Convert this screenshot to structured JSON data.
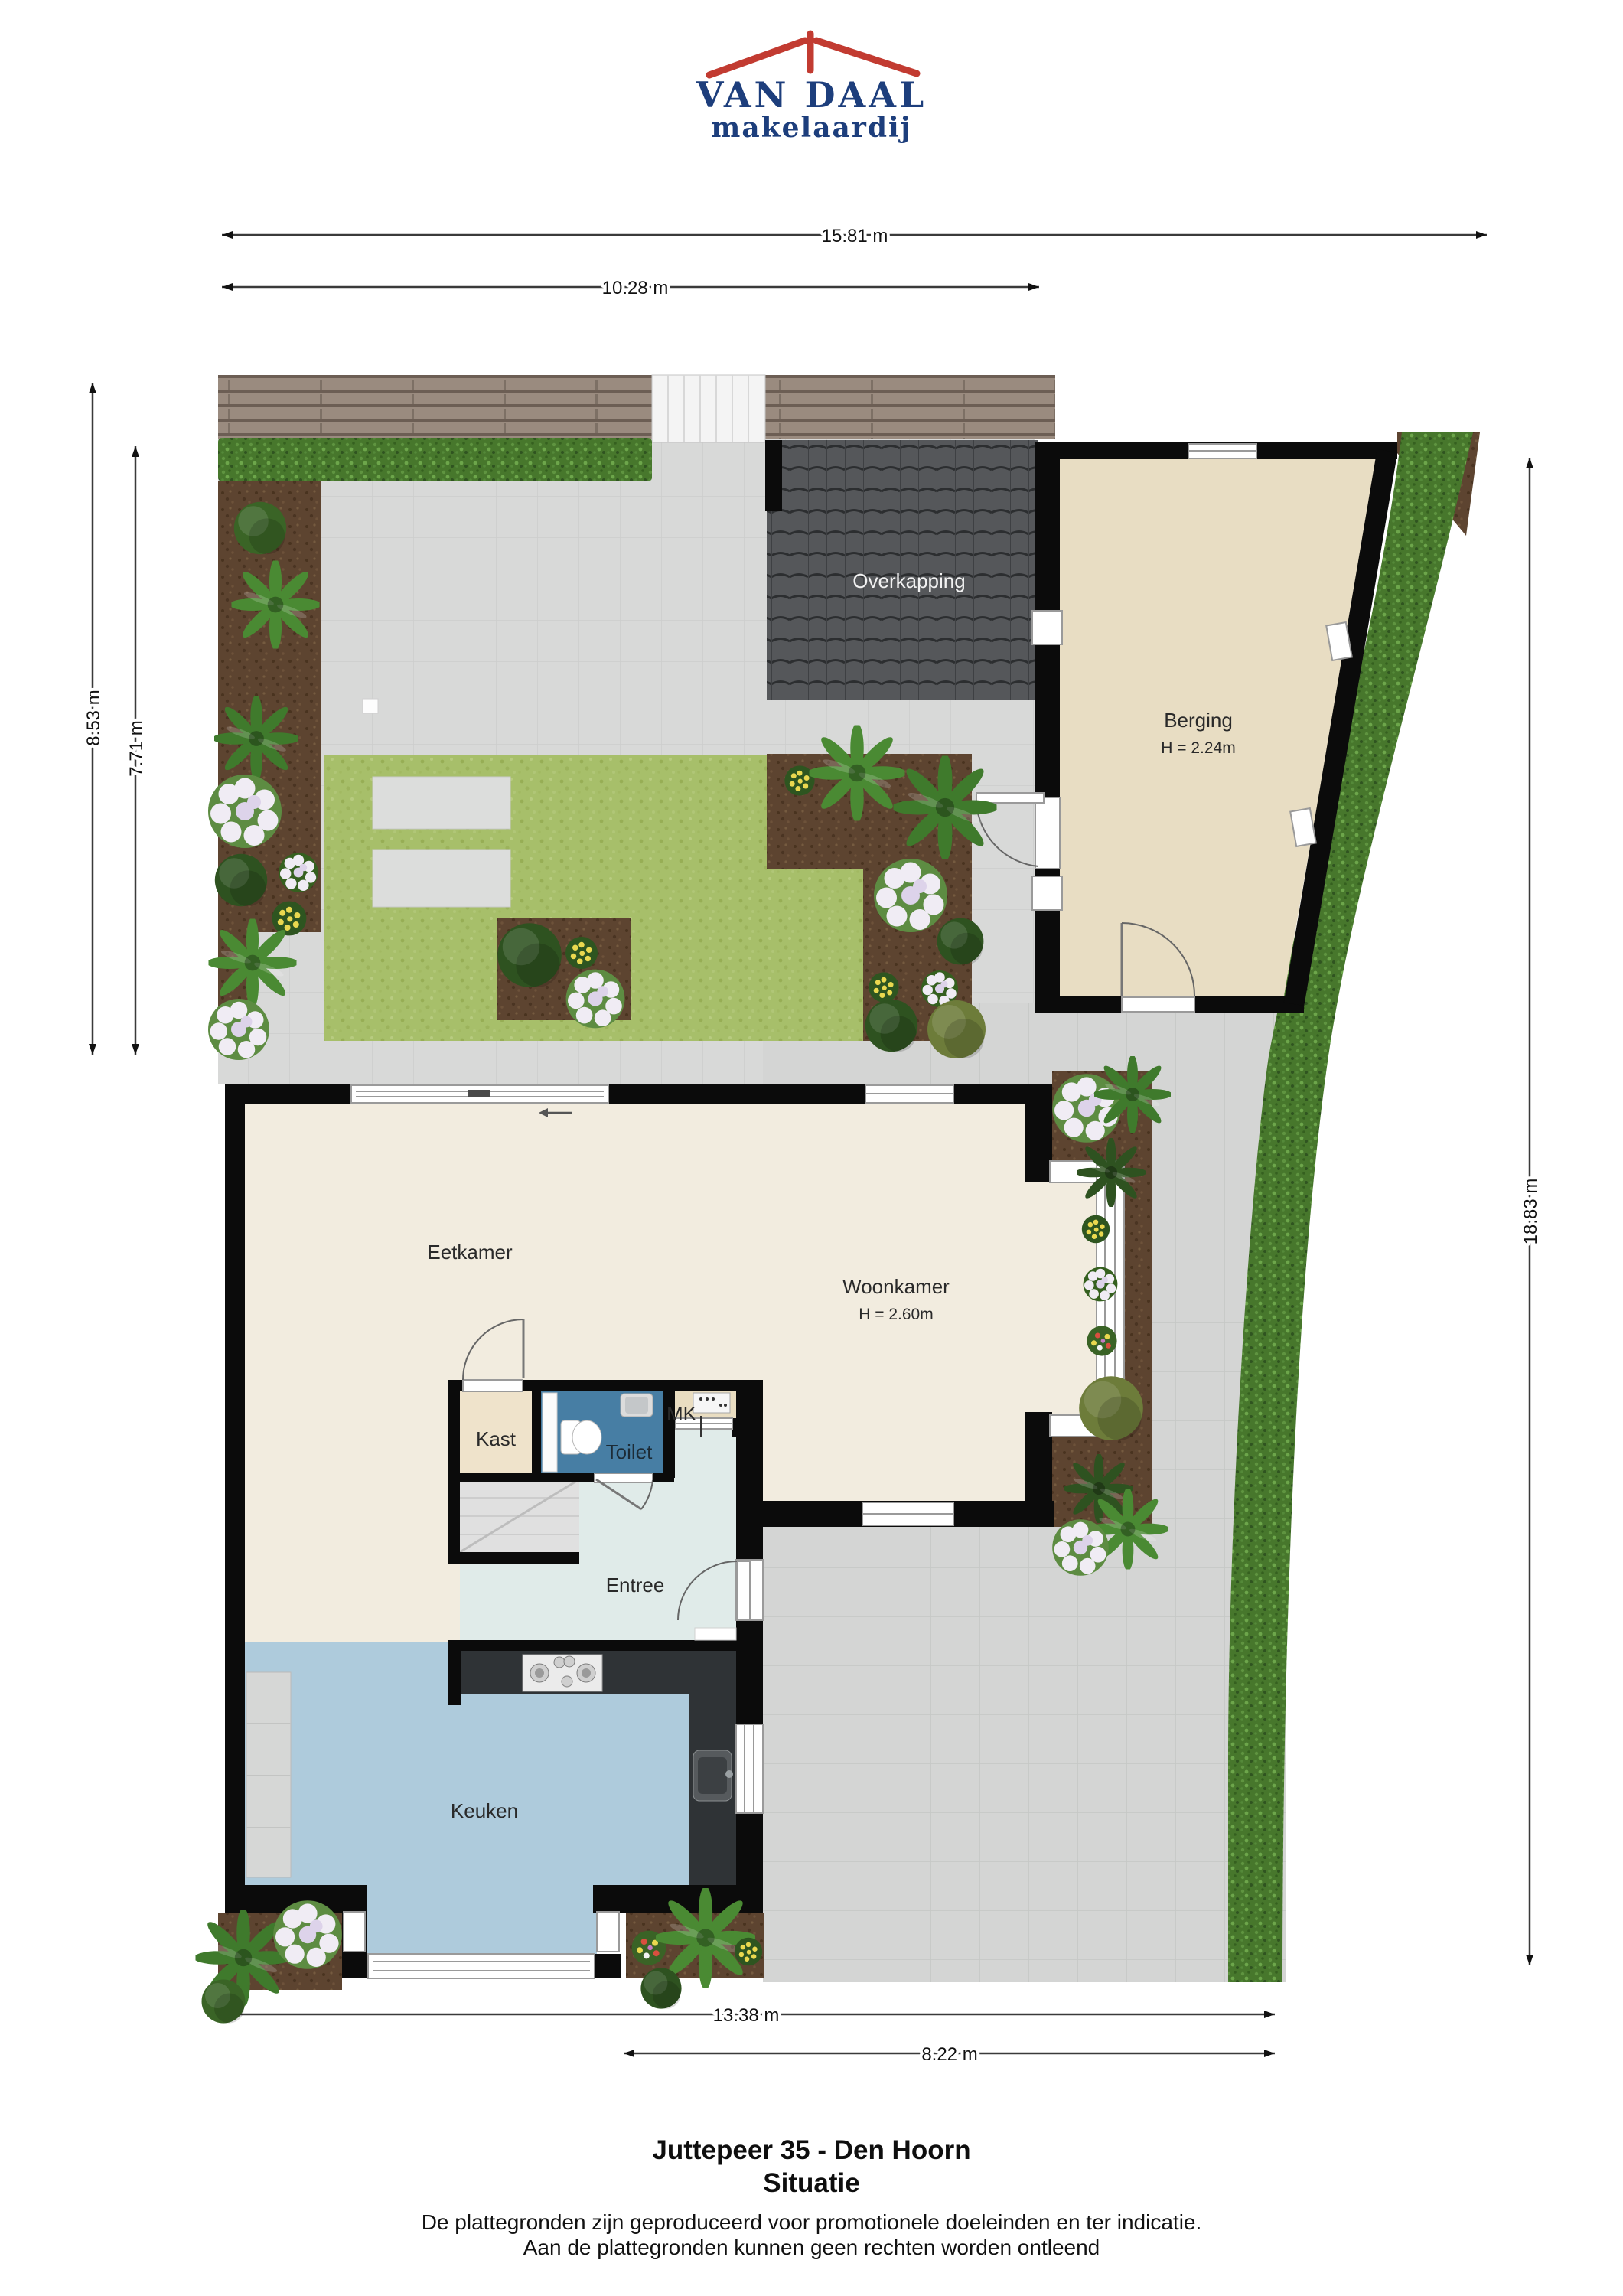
{
  "logo": {
    "name": "VAN DAAL",
    "tagline": "makelaardij"
  },
  "dimensions": {
    "top_total": "15.81 m",
    "top_left": "10.28 m",
    "left_outer": "8.53 m",
    "left_inner": "7.71 m",
    "right_side": "18.83 m",
    "bottom_total": "13.38 m",
    "bottom_right": "8.22 m"
  },
  "rooms": {
    "overkapping": "Overkapping",
    "berging": "Berging",
    "berging_height": "H = 2.24m",
    "eetkamer": "Eetkamer",
    "woonkamer": "Woonkamer",
    "woonkamer_height": "H = 2.60m",
    "kast": "Kast",
    "toilet": "Toilet",
    "mk": "MK",
    "entree": "Entree",
    "keuken": "Keuken"
  },
  "footer": {
    "title": "Juttepeer 35 - Den Hoorn",
    "subtitle": "Situatie",
    "disclaimer_line1": "De plattegronden zijn geproduceerd voor promotionele doeleinden en ter indicatie.",
    "disclaimer_line2": "Aan de plattegronden kunnen geen rechten worden ontleend"
  },
  "colors": {
    "brand_red": "#c23b31",
    "brand_blue": "#1d3e7c",
    "wall": "#0b0b0b",
    "floor_living": "#f2ecdf",
    "floor_entree": "#e0ebe9",
    "floor_kitchen": "#aecbdc",
    "floor_toilet": "#477ea4",
    "floor_storage": "#e8ddc3",
    "lawn": "#a7bf6a",
    "hedge": "#47772c",
    "soil": "#5d4430"
  }
}
